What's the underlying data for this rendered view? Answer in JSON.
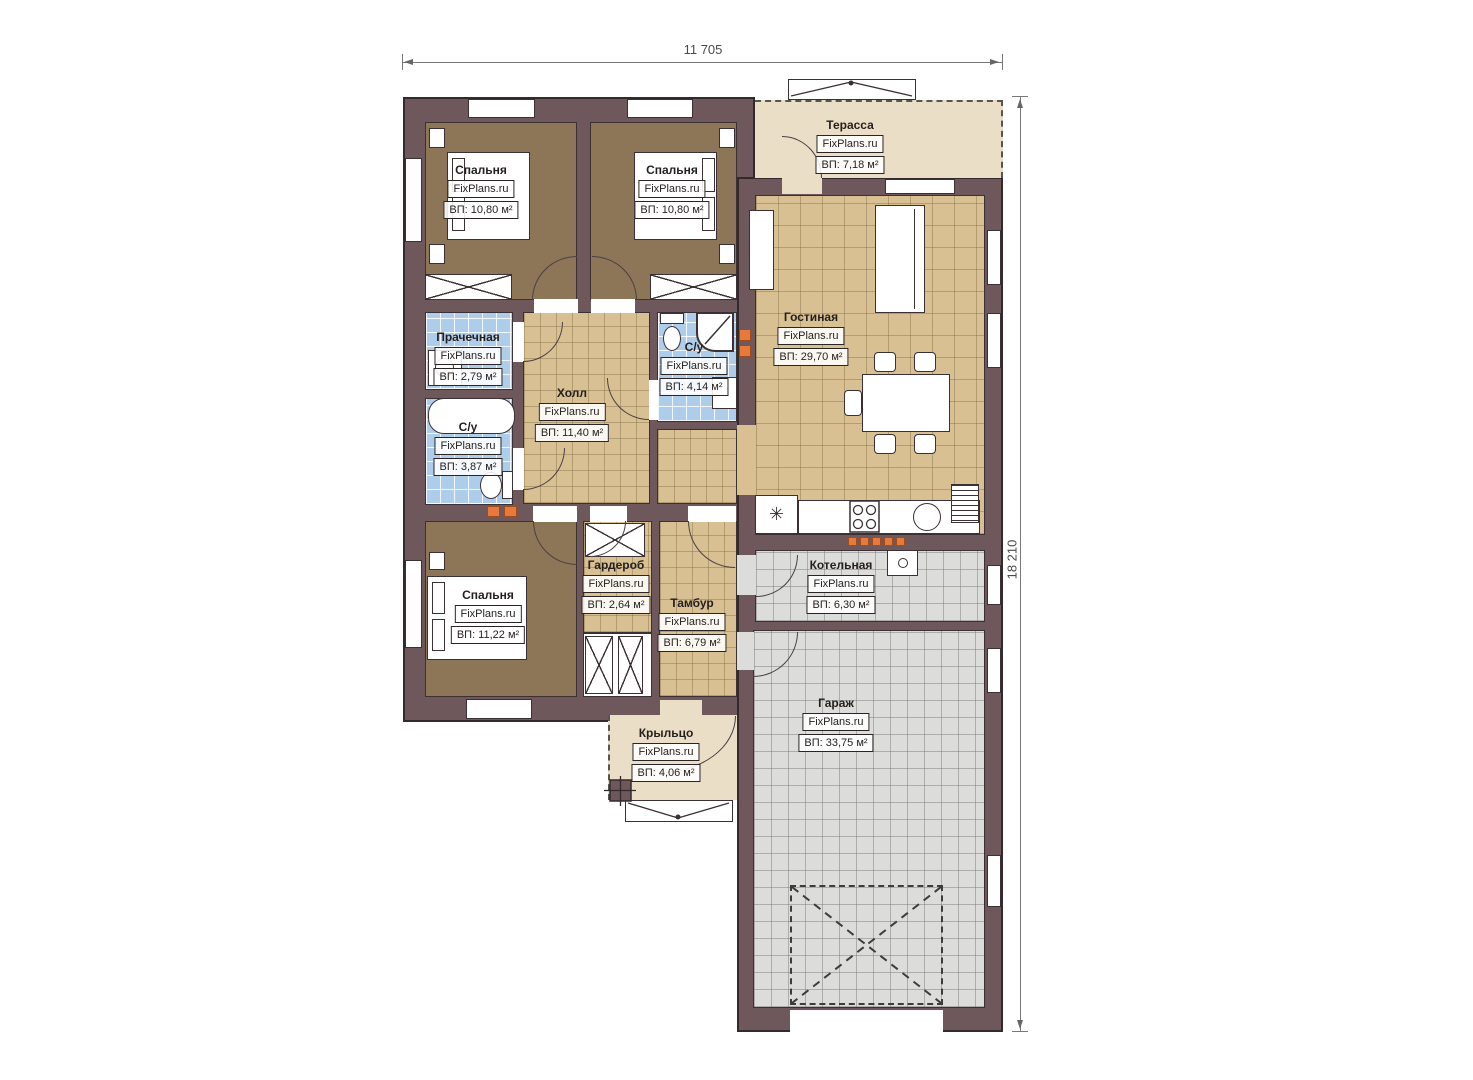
{
  "plan": {
    "brand": "FixPlans.ru",
    "dimensions": {
      "width": "11 705",
      "height": "18 210"
    },
    "icons": {
      "fridge_symbol": "✳"
    },
    "colors": {
      "wall": "#6e585c",
      "bedroom_floor": "#8d7557",
      "tile_tan": "#d8c092",
      "tile_blue": "#aecdea",
      "tile_gray": "#dcdcda",
      "deck": "#eadfc6",
      "radiator": "#e8793c"
    },
    "rooms": [
      {
        "key": "bedroom-1",
        "name": "Спальня",
        "brand": "FixPlans.ru",
        "area": "ВП: 10,80 м²"
      },
      {
        "key": "bedroom-2",
        "name": "Спальня",
        "brand": "FixPlans.ru",
        "area": "ВП: 10,80 м²"
      },
      {
        "key": "terrace",
        "name": "Терасса",
        "brand": "FixPlans.ru",
        "area": "ВП: 7,18 м²"
      },
      {
        "key": "laundry",
        "name": "Прачечная",
        "brand": "FixPlans.ru",
        "area": "ВП: 2,79 м²"
      },
      {
        "key": "hall",
        "name": "Холл",
        "brand": "FixPlans.ru",
        "area": "ВП: 11,40 м²"
      },
      {
        "key": "bathroom-1",
        "name": "С/у",
        "brand": "FixPlans.ru",
        "area": "ВП: 4,14 м²"
      },
      {
        "key": "living-room",
        "name": "Гостиная",
        "brand": "FixPlans.ru",
        "area": "ВП: 29,70 м²"
      },
      {
        "key": "bathroom-2",
        "name": "С/у",
        "brand": "FixPlans.ru",
        "area": "ВП: 3,87 м²"
      },
      {
        "key": "bedroom-3",
        "name": "Спальня",
        "brand": "FixPlans.ru",
        "area": "ВП: 11,22 м²"
      },
      {
        "key": "wardrobe",
        "name": "Гардероб",
        "brand": "FixPlans.ru",
        "area": "ВП: 2,64 м²"
      },
      {
        "key": "vestibule",
        "name": "Тамбур",
        "brand": "FixPlans.ru",
        "area": "ВП: 6,79 м²"
      },
      {
        "key": "boiler-room",
        "name": "Котельная",
        "brand": "FixPlans.ru",
        "area": "ВП: 6,30 м²"
      },
      {
        "key": "garage",
        "name": "Гараж",
        "brand": "FixPlans.ru",
        "area": "ВП: 33,75 м²"
      },
      {
        "key": "porch",
        "name": "Крыльцо",
        "brand": "FixPlans.ru",
        "area": "ВП: 4,06 м²"
      }
    ]
  }
}
